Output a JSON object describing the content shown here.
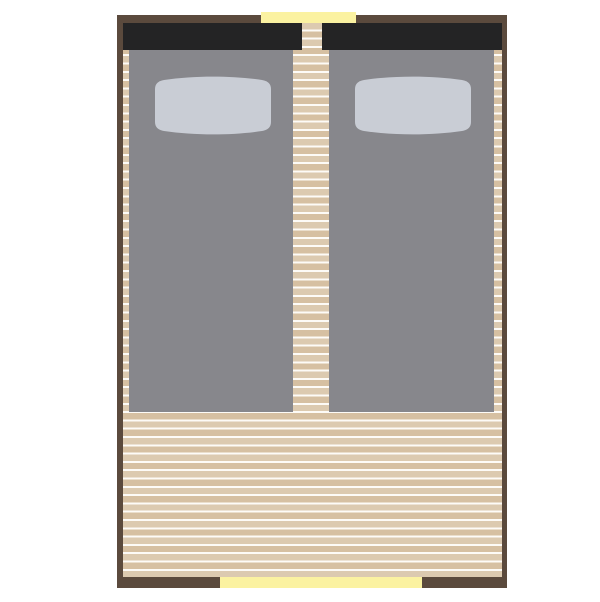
{
  "title": "Twin-bed room floor plan",
  "colors": {
    "background": "#ffffff",
    "wall": "#5b4a3d",
    "headboard": "#242425",
    "bed": "#87878c",
    "pillow": "#c9cdd5",
    "plank_light": "#dccab0",
    "plank_dark": "#d6c0a2",
    "plank_gap": "#fdfbf7",
    "opening": "#fbf2a1"
  },
  "scene": {
    "room": "rectangular room, top-down view",
    "floor": "horizontal wooden planks",
    "beds": [
      {
        "id": "left-bed",
        "headboard": true,
        "pillow": true
      },
      {
        "id": "right-bed",
        "headboard": true,
        "pillow": true
      }
    ],
    "openings": [
      {
        "id": "top-window",
        "side": "top",
        "color": "#fbf2a1"
      },
      {
        "id": "bottom-door",
        "side": "bottom",
        "color": "#fbf2a1"
      }
    ]
  }
}
